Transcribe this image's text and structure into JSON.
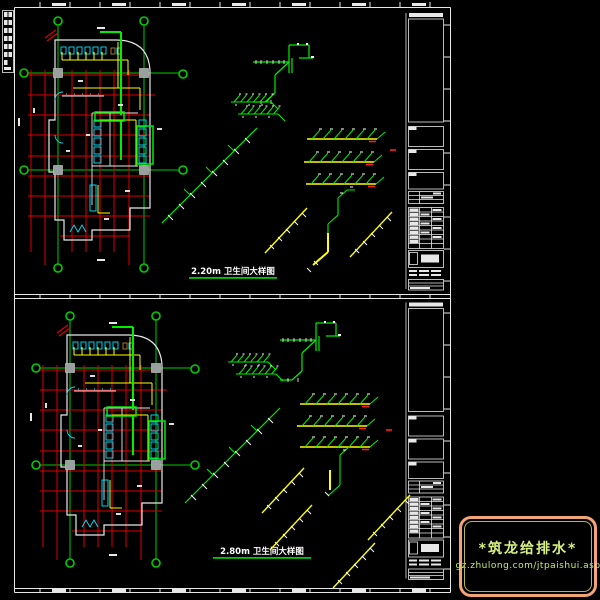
{
  "sheet": {
    "background": "#000000",
    "frame_color": "#ffffff",
    "colors": {
      "grid_red": "#e00000",
      "dimension_green": "#00cc00",
      "pipe_green": "#00ee00",
      "pipe_yellow": "#ffff00",
      "fixture_cyan": "#00e5ff",
      "wall_white": "#e8e8e8",
      "column_gray": "#9aa0a0",
      "accent_red": "#ff2020"
    }
  },
  "panels": {
    "top": {
      "title": "2.20m 卫生间大样图"
    },
    "bottom": {
      "title": "2.80m 卫生间大样图"
    }
  },
  "logo": {
    "title": "*筑龙给排水*",
    "url": "gz.zhulong.com/jtpaishui.asp",
    "outer_border": "#f2a478",
    "inner_border": "#b8b83a",
    "text_color": "#d8f080"
  }
}
